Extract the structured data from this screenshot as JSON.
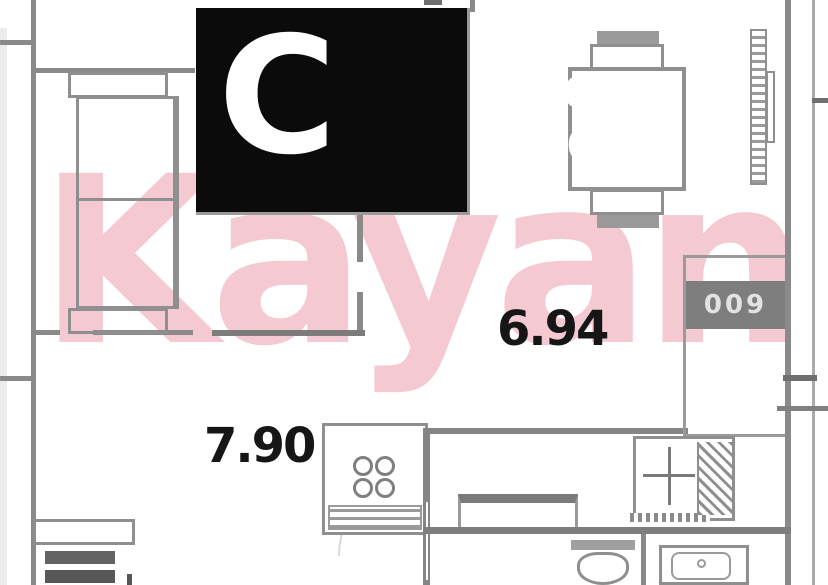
{
  "plan": {
    "watermark": "Kayan",
    "info_box": {
      "unit_type": "С",
      "area_1": "7,90",
      "area_2": "22,67",
      "area_3": "26,68"
    },
    "room_labels": {
      "living": "7.90",
      "kitchen": "6.94"
    },
    "appliance_code": "009"
  },
  "colors": {
    "wall": "#8a8a8a",
    "furniture_line": "#8f8f8f",
    "watermark_pink": "#f4c9d1",
    "info_box_bg": "#0b0b0b",
    "info_box_text": "#ffffff",
    "label_text": "#161616",
    "appliance_bg": "#7e7e7e"
  }
}
